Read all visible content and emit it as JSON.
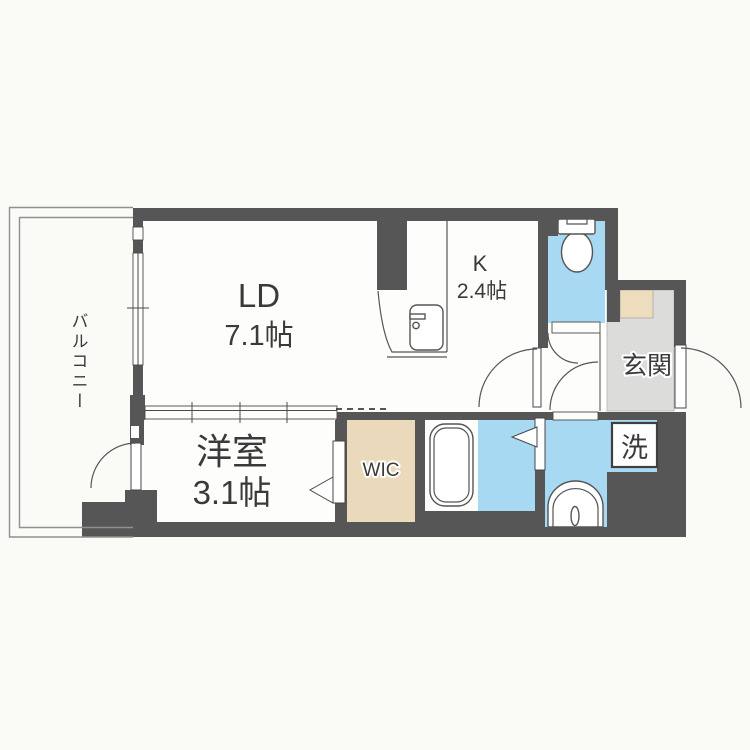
{
  "type": "floor-plan",
  "colors": {
    "bg": "#fafaf7",
    "floor": "#fdfdfb",
    "wall": "#565656",
    "water": "#a8d9f2",
    "wic": "#ead9ba",
    "genkan": "#dcdcda",
    "mat": "#edddbd",
    "text": "#3a3a3a"
  },
  "rooms": {
    "balcony": {
      "label": "バルコニー"
    },
    "living_dining": {
      "name": "LD",
      "size": "7.1帖"
    },
    "kitchen": {
      "name": "K",
      "size": "2.4帖"
    },
    "western_room": {
      "name": "洋室",
      "size": "3.1帖"
    },
    "walk_in_closet": {
      "label": "WIC"
    },
    "entrance": {
      "label": "玄関"
    },
    "laundry": {
      "label": "洗"
    }
  },
  "fixtures": {
    "toilet": "toilet-icon",
    "kitchen_sink": "kitchen-sink-icon",
    "bathtub": "bathtub-icon",
    "washbasin": "washbasin-icon",
    "washing_machine": "washing-machine-box"
  }
}
